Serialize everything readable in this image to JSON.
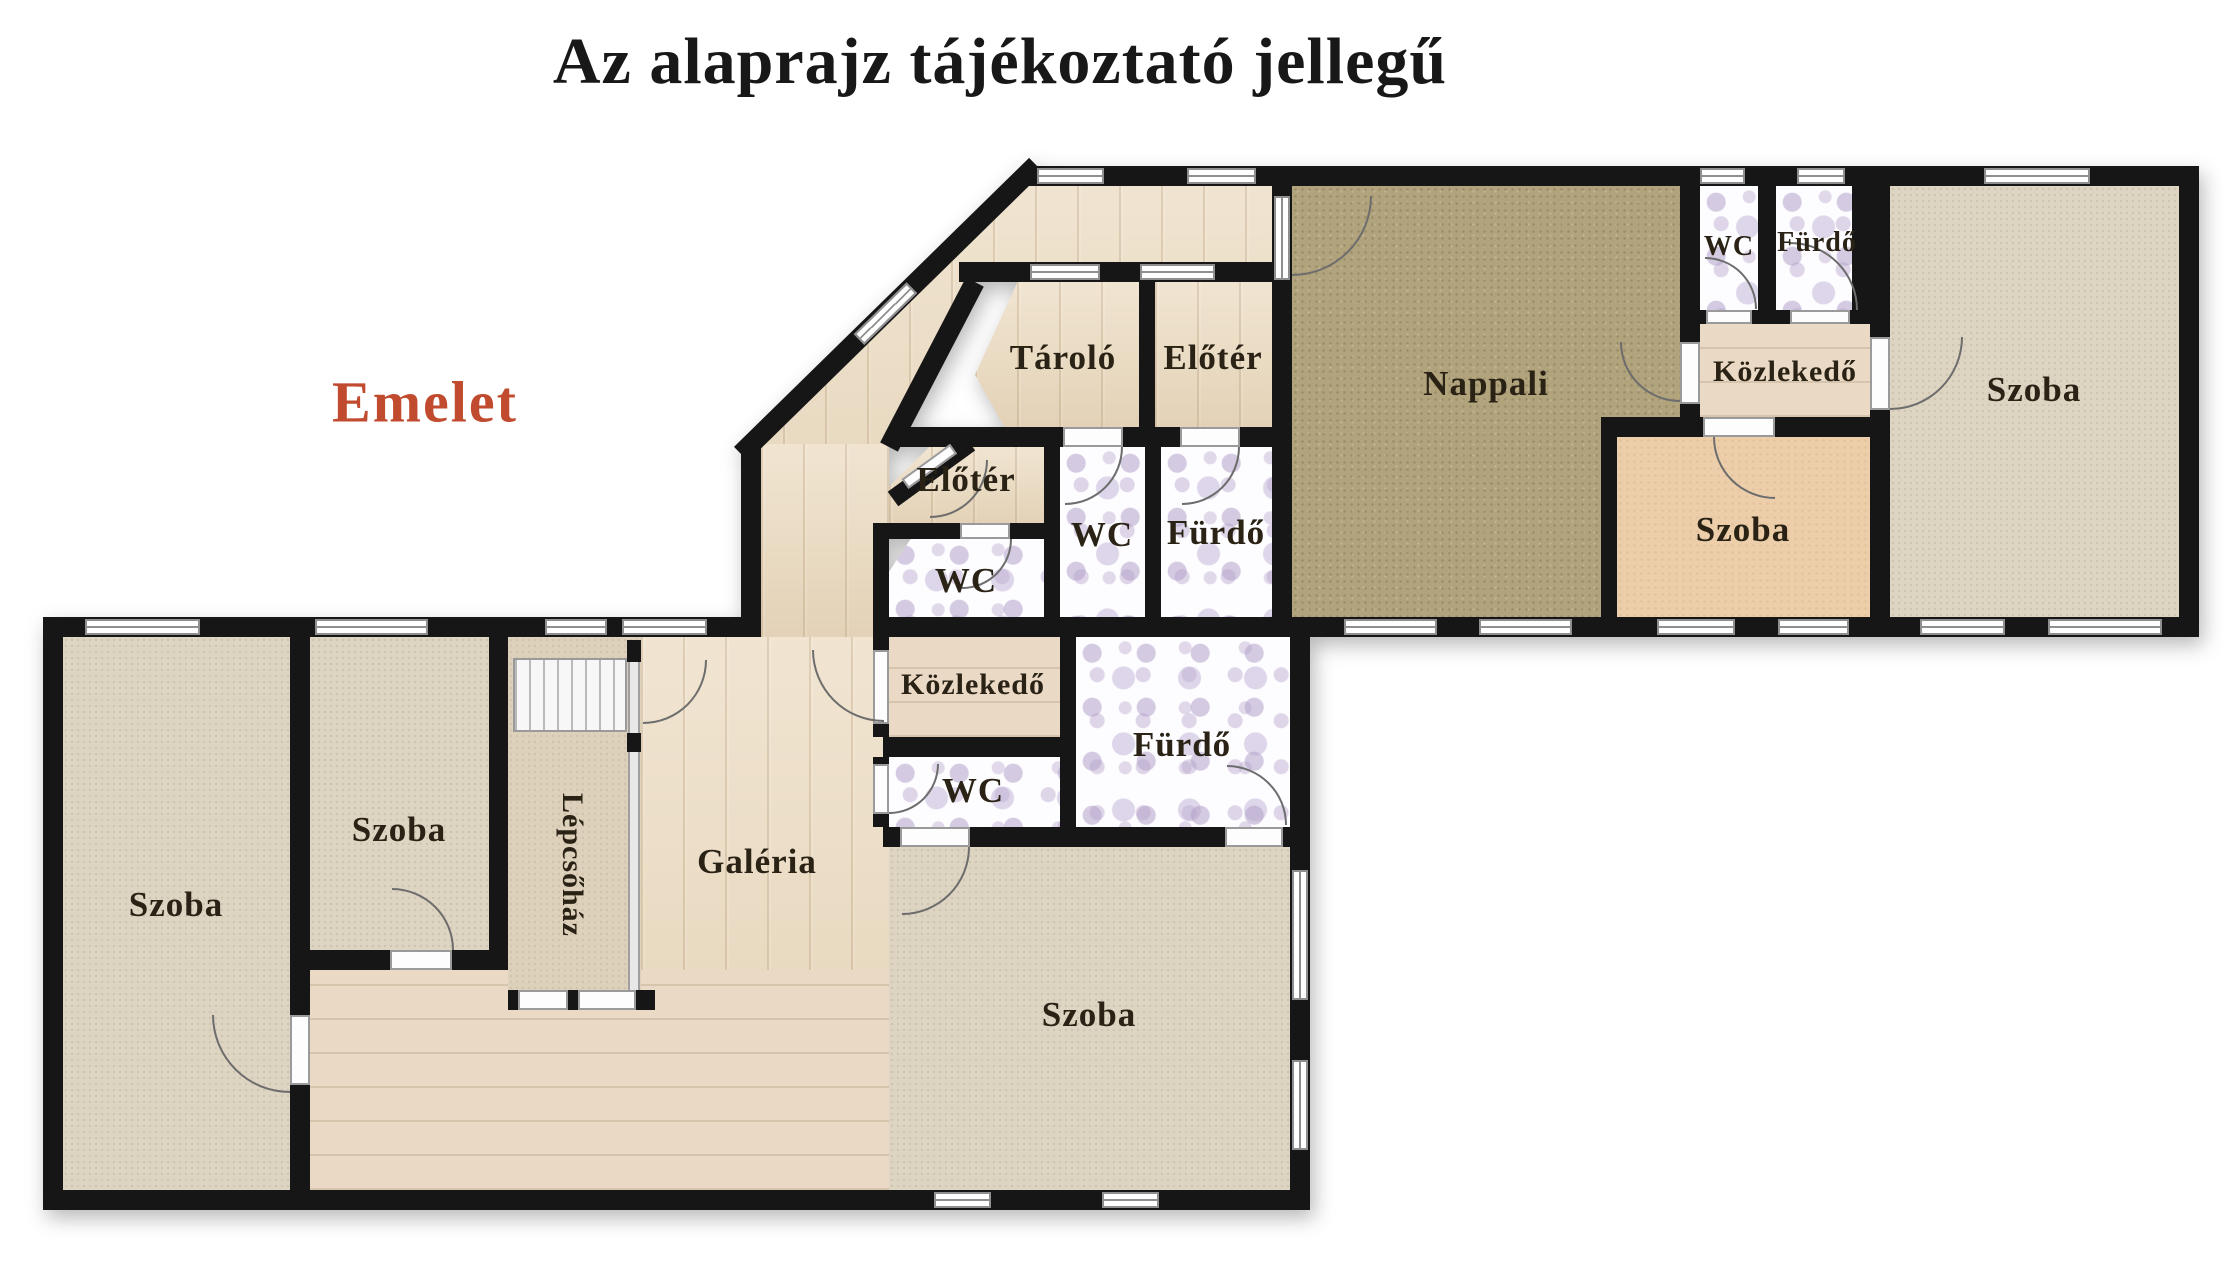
{
  "header": {
    "title": "Az alaprajz tájékoztató jellegű",
    "floor_label": "Emelet"
  },
  "colors": {
    "accent_floor_label": "#c14b2e",
    "wall": "#161616",
    "wood_floor": "#ecdcc2",
    "carpet_greige": "#ddd4c1",
    "carpet_khaki": "#b1a37c",
    "carpet_peach": "#ecceaa",
    "bathroom_tile_flower": "#b2a0c8",
    "title_text": "#181818",
    "room_label_text": "#2a2315"
  },
  "rooms": {
    "tarolo": {
      "label": "Tároló"
    },
    "eloter_felso": {
      "label": "Előtér"
    },
    "eloter_also": {
      "label": "Előtér"
    },
    "wc_kozep": {
      "label": "WC"
    },
    "furdo_kozep": {
      "label": "Fürdő"
    },
    "wc_eloter": {
      "label": "WC"
    },
    "nappali": {
      "label": "Nappali"
    },
    "wc_jobb": {
      "label": "WC"
    },
    "furdo_jobb": {
      "label": "Fürdő"
    },
    "kozlekedo_jobb": {
      "label": "Közlekedő"
    },
    "szoba_jobb": {
      "label": "Szoba"
    },
    "szoba_kozep": {
      "label": "Szoba"
    },
    "szoba_bal": {
      "label": "Szoba"
    },
    "szoba_bal2": {
      "label": "Szoba"
    },
    "lepcsohaz": {
      "label": "Lépcsőház"
    },
    "galeria": {
      "label": "Galéria"
    },
    "kozlekedo_also": {
      "label": "Közlekedő"
    },
    "wc_also": {
      "label": "WC"
    },
    "furdo_also": {
      "label": "Fürdő"
    },
    "szoba_also": {
      "label": "Szoba"
    }
  }
}
